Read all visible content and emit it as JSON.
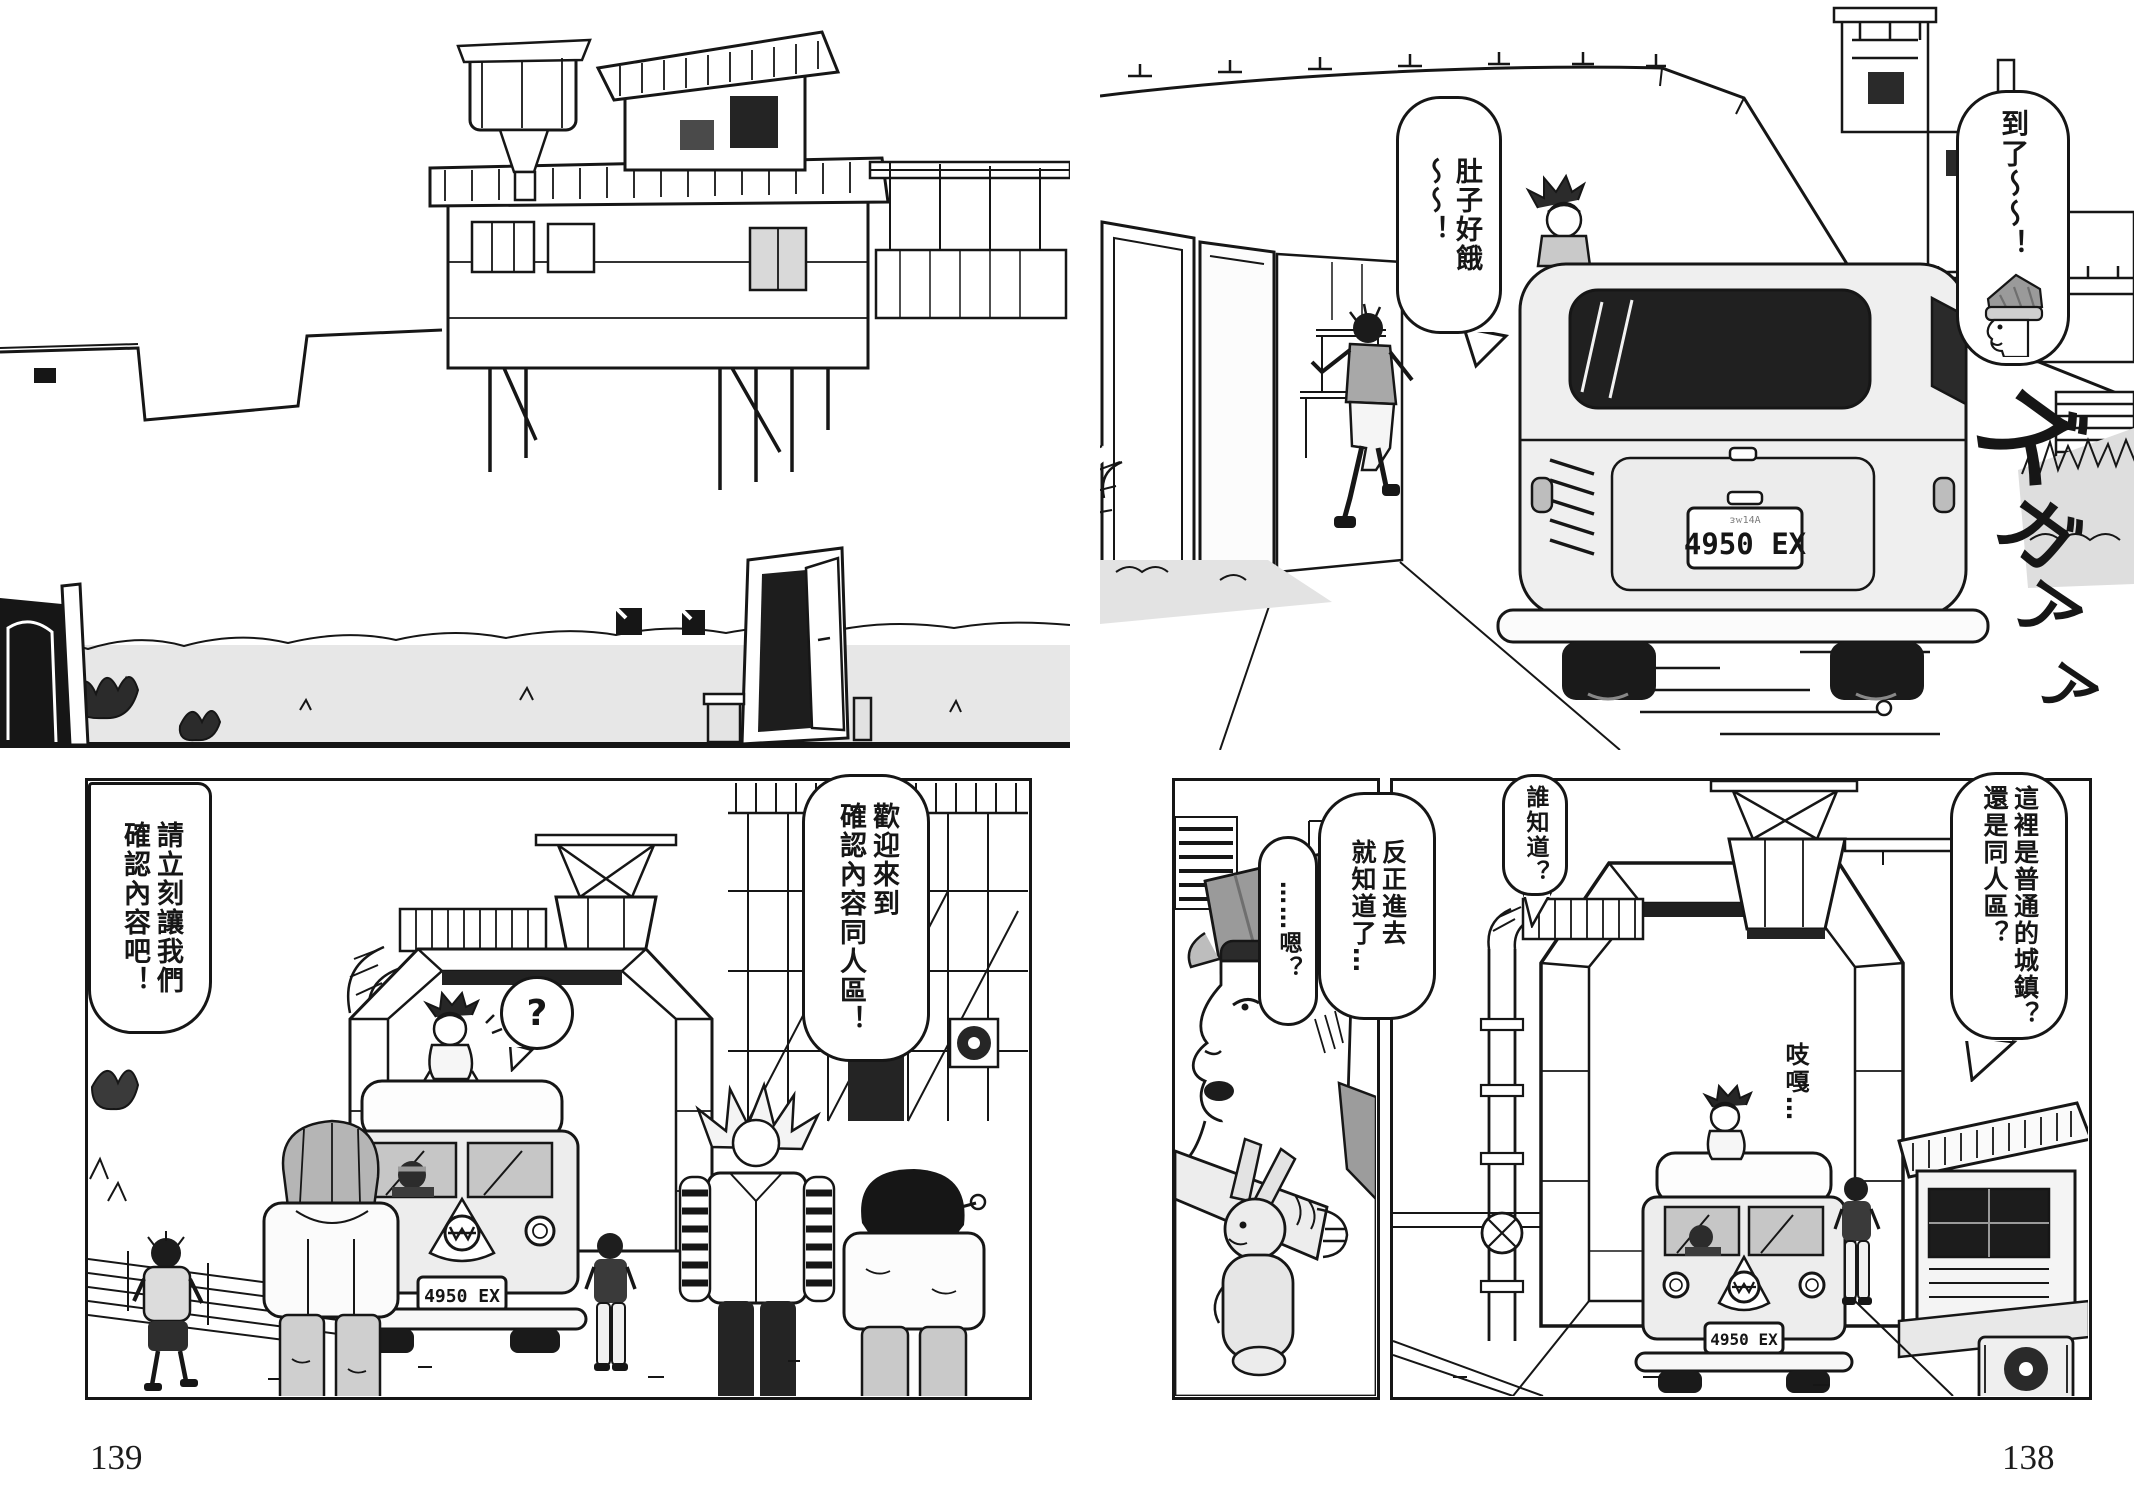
{
  "palette": {
    "ink": "#161616",
    "paper": "#ffffff",
    "tone_light": "#e8e8e8",
    "tone_mid": "#b5b5b5",
    "tone_dark": "#222222"
  },
  "page_numbers": {
    "left": "139",
    "right": "138"
  },
  "license_plate": "4950 EX",
  "bubbles": {
    "arrived": "到了～～！",
    "hungry": "肚子好餓\n～～！",
    "please_confirm": "請立刻讓我們\n確認內容吧！",
    "welcome": "歡迎來到\n確認內容同人區！",
    "question": "?",
    "anyway": "反正進去\n就知道了…",
    "hmm": "……嗯？",
    "who_knows": "誰知道？",
    "which_district": "這裡是普通的城鎮？\n還是同人區？",
    "creak": "吱嘎…"
  },
  "sfx": {
    "text": "ズガアア",
    "chars": [
      "ズ",
      "ガ",
      "ア",
      "ア"
    ]
  }
}
